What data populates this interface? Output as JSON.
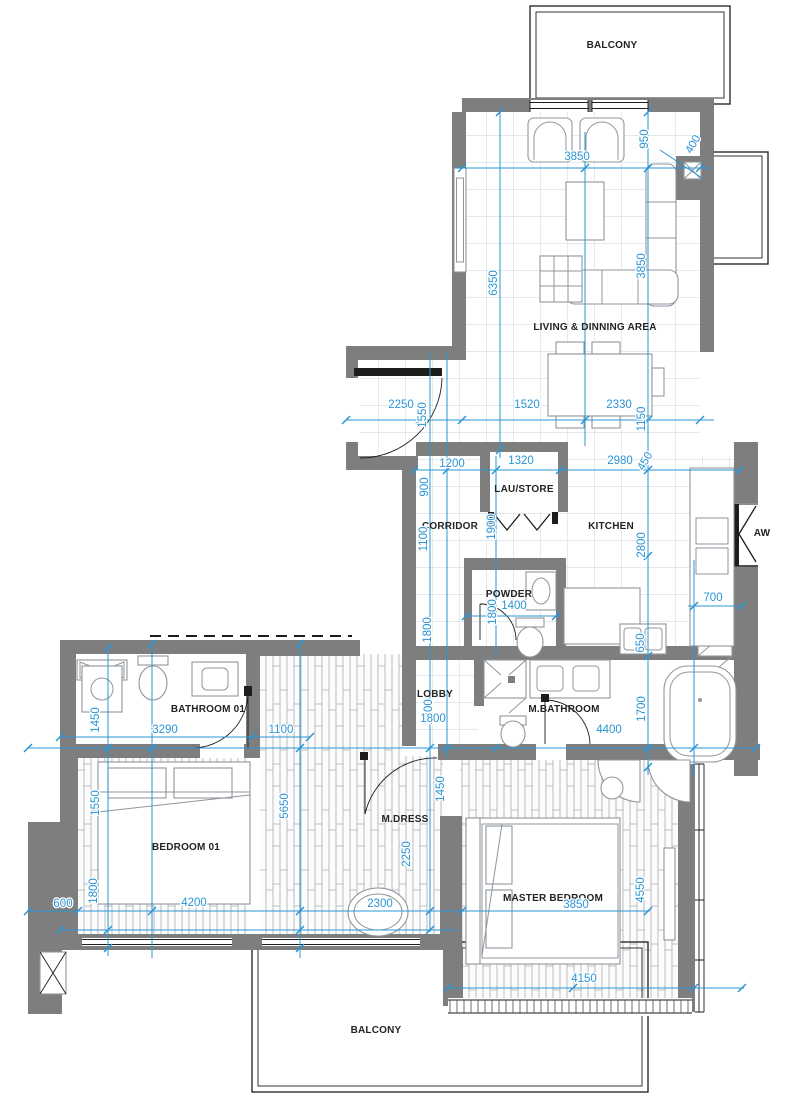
{
  "colors": {
    "wall": "#7e7e7e",
    "dimension": "#2a94d4",
    "outline": "#1d1d1d"
  },
  "rooms": [
    {
      "id": "balcony-top",
      "label": "BALCONY",
      "x": 612,
      "y": 48
    },
    {
      "id": "living-dining",
      "label": "LIVING & DINNING AREA",
      "x": 595,
      "y": 330
    },
    {
      "id": "lau-store",
      "label": "LAU/STORE",
      "x": 524,
      "y": 492
    },
    {
      "id": "corridor",
      "label": "CORRIDOR",
      "x": 450,
      "y": 529
    },
    {
      "id": "kitchen",
      "label": "KITCHEN",
      "x": 611,
      "y": 529
    },
    {
      "id": "aw-window",
      "label": "AW",
      "x": 762,
      "y": 536
    },
    {
      "id": "powder",
      "label": "POWDER",
      "x": 509,
      "y": 597
    },
    {
      "id": "bathroom-01",
      "label": "BATHROOM 01",
      "x": 208,
      "y": 712
    },
    {
      "id": "lobby",
      "label": "LOBBY",
      "x": 435,
      "y": 697
    },
    {
      "id": "m-bathroom",
      "label": "M.BATHROOM",
      "x": 564,
      "y": 712
    },
    {
      "id": "bedroom-01",
      "label": "BEDROOM 01",
      "x": 186,
      "y": 850
    },
    {
      "id": "m-dress",
      "label": "M.DRESS",
      "x": 405,
      "y": 822
    },
    {
      "id": "master-bedroom",
      "label": "MASTER BEDROOM",
      "x": 553,
      "y": 901
    },
    {
      "id": "balcony-bottom",
      "label": "BALCONY",
      "x": 376,
      "y": 1033
    }
  ],
  "dimensions": [
    {
      "value": "3850",
      "x": 577,
      "y": 160,
      "rot": 0
    },
    {
      "value": "950",
      "x": 648,
      "y": 139,
      "rot": -90
    },
    {
      "value": "400",
      "x": 696,
      "y": 146,
      "rot": -60
    },
    {
      "value": "6350",
      "x": 497,
      "y": 283,
      "rot": -90
    },
    {
      "value": "3850",
      "x": 645,
      "y": 266,
      "rot": -90
    },
    {
      "value": "2250",
      "x": 401,
      "y": 408,
      "rot": 0
    },
    {
      "value": "1550",
      "x": 426,
      "y": 415,
      "rot": -90
    },
    {
      "value": "1520",
      "x": 527,
      "y": 408,
      "rot": 0
    },
    {
      "value": "2330",
      "x": 619,
      "y": 408,
      "rot": 0
    },
    {
      "value": "1150",
      "x": 645,
      "y": 419,
      "rot": -90
    },
    {
      "value": "1200",
      "x": 452,
      "y": 467,
      "rot": 0
    },
    {
      "value": "1320",
      "x": 521,
      "y": 464,
      "rot": 0
    },
    {
      "value": "2980",
      "x": 620,
      "y": 464,
      "rot": 0
    },
    {
      "value": "450",
      "x": 648,
      "y": 463,
      "rot": -60
    },
    {
      "value": "900",
      "x": 428,
      "y": 487,
      "rot": -90
    },
    {
      "value": "1100",
      "x": 427,
      "y": 539,
      "rot": -90
    },
    {
      "value": "1900",
      "x": 495,
      "y": 527,
      "rot": -90
    },
    {
      "value": "2800",
      "x": 645,
      "y": 545,
      "rot": -90
    },
    {
      "value": "1400",
      "x": 514,
      "y": 609,
      "rot": 0
    },
    {
      "value": "1800",
      "x": 496,
      "y": 612,
      "rot": -90
    },
    {
      "value": "700",
      "x": 713,
      "y": 601,
      "rot": 0
    },
    {
      "value": "650",
      "x": 644,
      "y": 643,
      "rot": -90
    },
    {
      "value": "1800",
      "x": 431,
      "y": 630,
      "rot": -90
    },
    {
      "value": "1700",
      "x": 432,
      "y": 712,
      "rot": -90
    },
    {
      "value": "1800",
      "x": 433,
      "y": 722,
      "rot": 0
    },
    {
      "value": "1700",
      "x": 645,
      "y": 709,
      "rot": -90
    },
    {
      "value": "4400",
      "x": 609,
      "y": 733,
      "rot": 0
    },
    {
      "value": "3290",
      "x": 165,
      "y": 733,
      "rot": 0
    },
    {
      "value": "1450",
      "x": 99,
      "y": 720,
      "rot": -90
    },
    {
      "value": "1100",
      "x": 281,
      "y": 733,
      "rot": 0
    },
    {
      "value": "1550",
      "x": 99,
      "y": 803,
      "rot": -90
    },
    {
      "value": "1800",
      "x": 97,
      "y": 891,
      "rot": -90
    },
    {
      "value": "5650",
      "x": 288,
      "y": 806,
      "rot": -90
    },
    {
      "value": "2250",
      "x": 410,
      "y": 854,
      "rot": -90
    },
    {
      "value": "1450",
      "x": 444,
      "y": 789,
      "rot": -90
    },
    {
      "value": "600",
      "x": 63,
      "y": 907,
      "rot": 0
    },
    {
      "value": "4200",
      "x": 194,
      "y": 906,
      "rot": 0
    },
    {
      "value": "2300",
      "x": 380,
      "y": 907,
      "rot": 0
    },
    {
      "value": "3850",
      "x": 576,
      "y": 908,
      "rot": 0
    },
    {
      "value": "4550",
      "x": 644,
      "y": 890,
      "rot": -90
    },
    {
      "value": "4150",
      "x": 584,
      "y": 982,
      "rot": 0
    }
  ]
}
